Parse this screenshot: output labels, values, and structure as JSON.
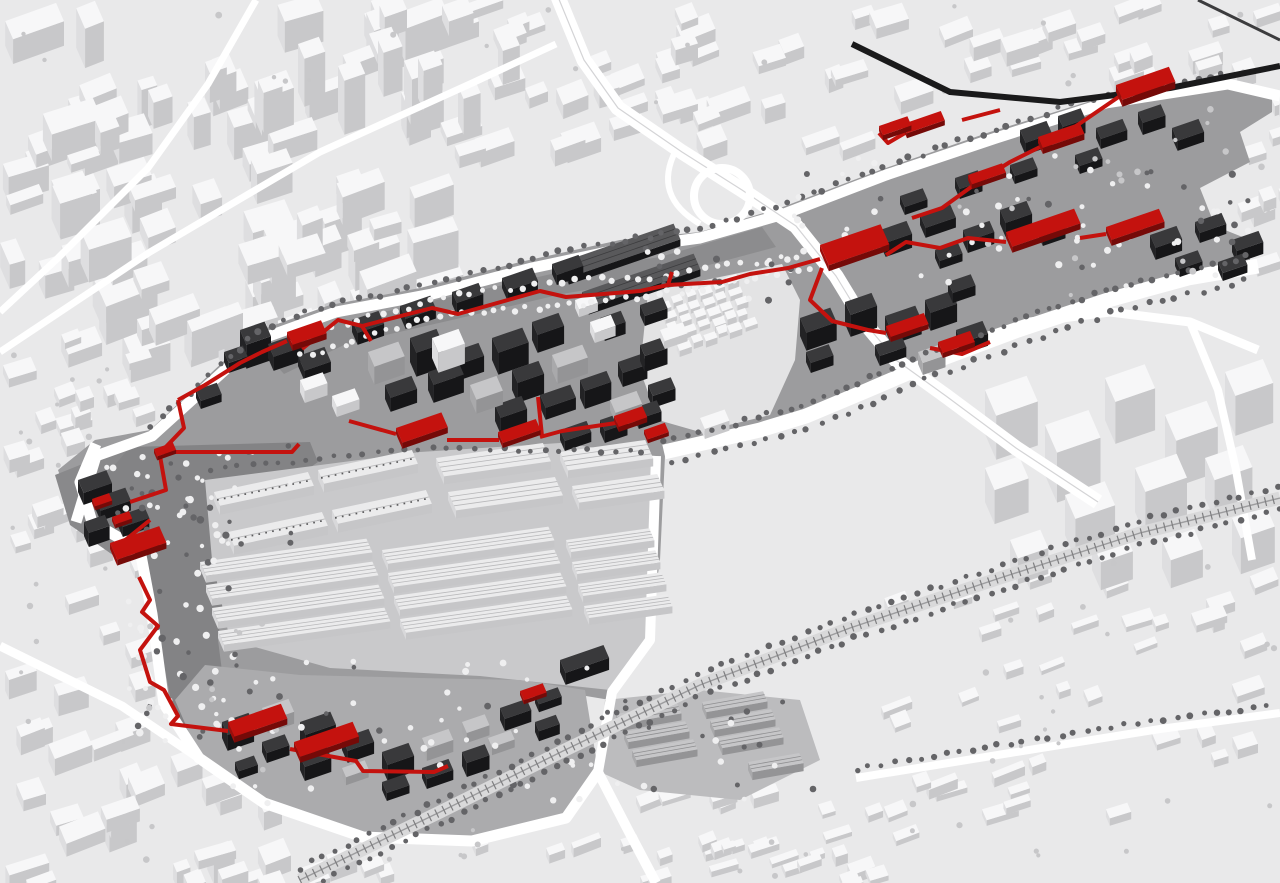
{
  "scene": {
    "description": "Axonometric aerial rendering of an urban masterplan: white surrounding city fabric, a diagonal redevelopment site with dark charcoal buildings, an industrial warehouse yard, and a continuous red pedestrian route network snaking through the plan.",
    "canvas": {
      "width": 1280,
      "height": 883
    }
  },
  "palette": {
    "background": "#e9e9ea",
    "city_roof": "#f7f7f8",
    "city_side1": "#dedee0",
    "city_side2": "#c8c8ca",
    "site_ground": "#9c9c9e",
    "site_ground_dark": "#89898b",
    "boulevard_ground": "#838385",
    "yard_ground": "#c9c9cb",
    "district_ground": "#ababad",
    "east_ground": "#bcbcbe",
    "village_ground": "#e3e3e4",
    "dark_roof": "#39393b",
    "dark_side1": "#232325",
    "dark_side2": "#161618",
    "mid_roof": "#c6c6c8",
    "mid_side1": "#a9a9ab",
    "mid_side2": "#949496",
    "warehouse_roof": "#ebebec",
    "warehouse_side1": "#d8d8da",
    "warehouse_side2": "#c6c6c8",
    "warehouse_rib": "#b8b8ba",
    "shed_roof": "#59595b",
    "road_white": "#ffffff",
    "rail_black": "#1a1a1b",
    "tie_gray": "#7e7e80",
    "corridor_gray": "#d9d9da",
    "tree_light": "#efeff0",
    "tree_dark": "#646467",
    "tree_bg": "#c7c7c9",
    "red": "#c4120e",
    "red_side1": "#9a0e0b",
    "red_side2": "#750a08"
  },
  "regions": [
    {
      "name": "surrounding-city-fabric"
    },
    {
      "name": "masterplan-site"
    },
    {
      "name": "industrial-warehouse-yard"
    },
    {
      "name": "southern-residential-quarter"
    },
    {
      "name": "white-lowrise-village"
    },
    {
      "name": "eastern-highrise-towers"
    },
    {
      "name": "highway-interchange"
    },
    {
      "name": "railway-corridors"
    },
    {
      "name": "red-route-network"
    }
  ]
}
